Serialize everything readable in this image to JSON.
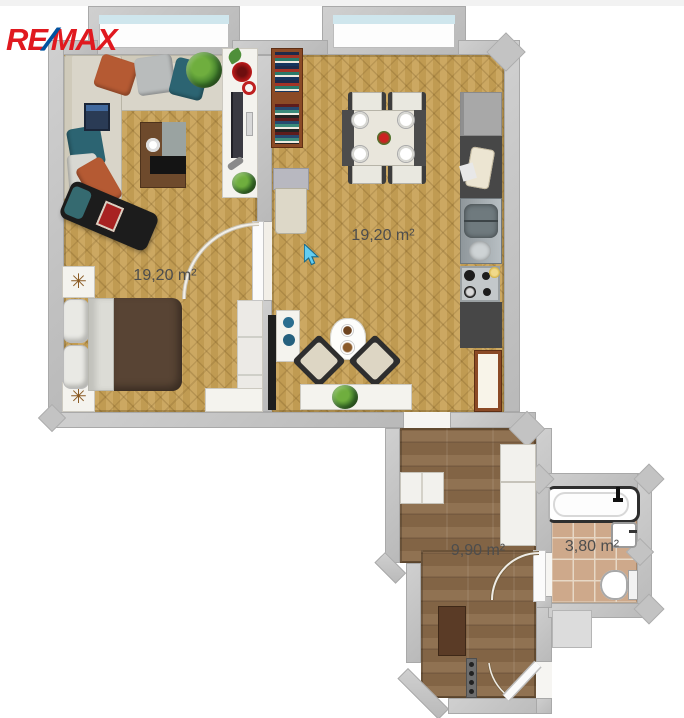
{
  "brand": {
    "re": "RE",
    "slash": "/",
    "max": "MAX",
    "red": "#e0191f",
    "blue": "#0053a0"
  },
  "rooms": {
    "living": {
      "area_label": "19,20 m²"
    },
    "dining": {
      "area_label": "19,20 m²"
    },
    "hall": {
      "area_label": "9,90 m²"
    },
    "bath": {
      "area_label": "3,80 m²"
    }
  },
  "icons": {
    "nightstand_decor": "✳"
  },
  "colors": {
    "wall": "#c3c3c3",
    "parquet": "#c8a155",
    "hall_floor": "#8a6a49",
    "tiles": "#cea98b",
    "kitchen_counter": "#474747",
    "label_text": "#4d4d4d",
    "cursor": "#63cdf2",
    "brand_red": "#e0191f",
    "brand_blue": "#0053a0"
  }
}
